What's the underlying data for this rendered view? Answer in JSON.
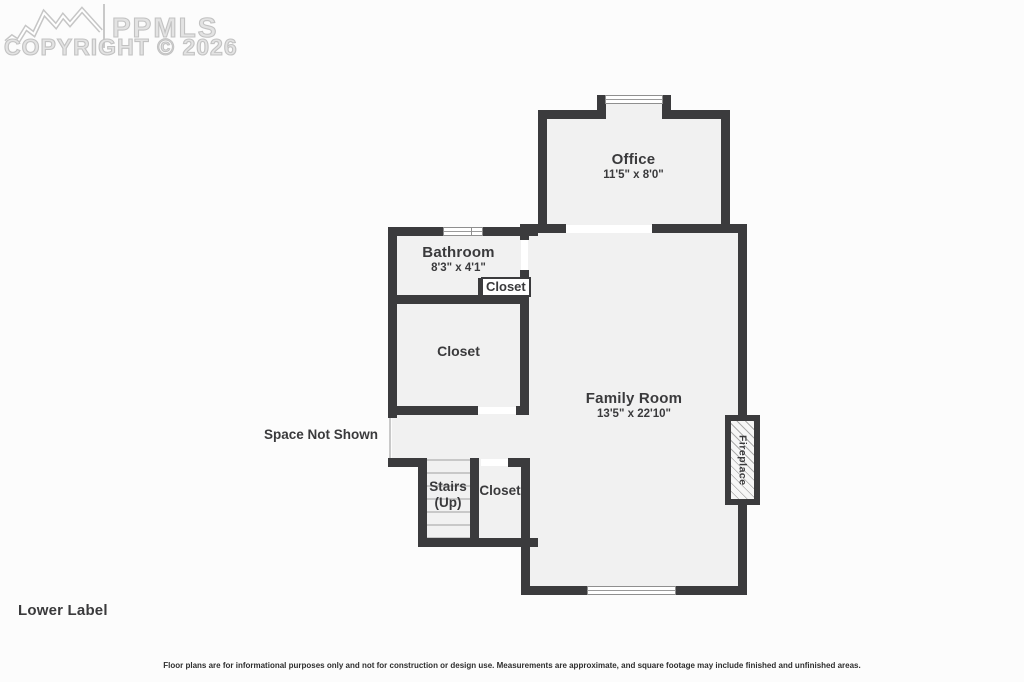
{
  "watermark": {
    "brand": "PPMLS",
    "copyright": "COPYRIGHT © 2026",
    "logo": "mountain-ridge-logo"
  },
  "rooms": {
    "office": {
      "name": "Office",
      "dims": "11'5\" x 8'0\""
    },
    "bathroom": {
      "name": "Bathroom",
      "dims": "8'3\" x 4'1\""
    },
    "closet_small": {
      "name": "Closet"
    },
    "closet_large": {
      "name": "Closet"
    },
    "family_room": {
      "name": "Family Room",
      "dims": "13'5\" x 22'10\""
    },
    "stairs": {
      "name": "Stairs",
      "direction": "(Up)"
    },
    "closet_lower": {
      "name": "Closet"
    },
    "fireplace": {
      "name": "Fireplace"
    }
  },
  "annotations": {
    "space_not_shown": "Space Not Shown",
    "lower_label": "Lower Label"
  },
  "footer": {
    "disclaimer": "Floor plans are for informational purposes only and not for construction or design use. Measurements are approximate, and square footage may include finished and unfinished areas."
  },
  "colors": {
    "wall": "#3b3b3d",
    "room_fill": "#f1f1f1",
    "text": "#3a3a3c",
    "watermark": "#c9c9c9",
    "background": "#fcfcfc"
  }
}
